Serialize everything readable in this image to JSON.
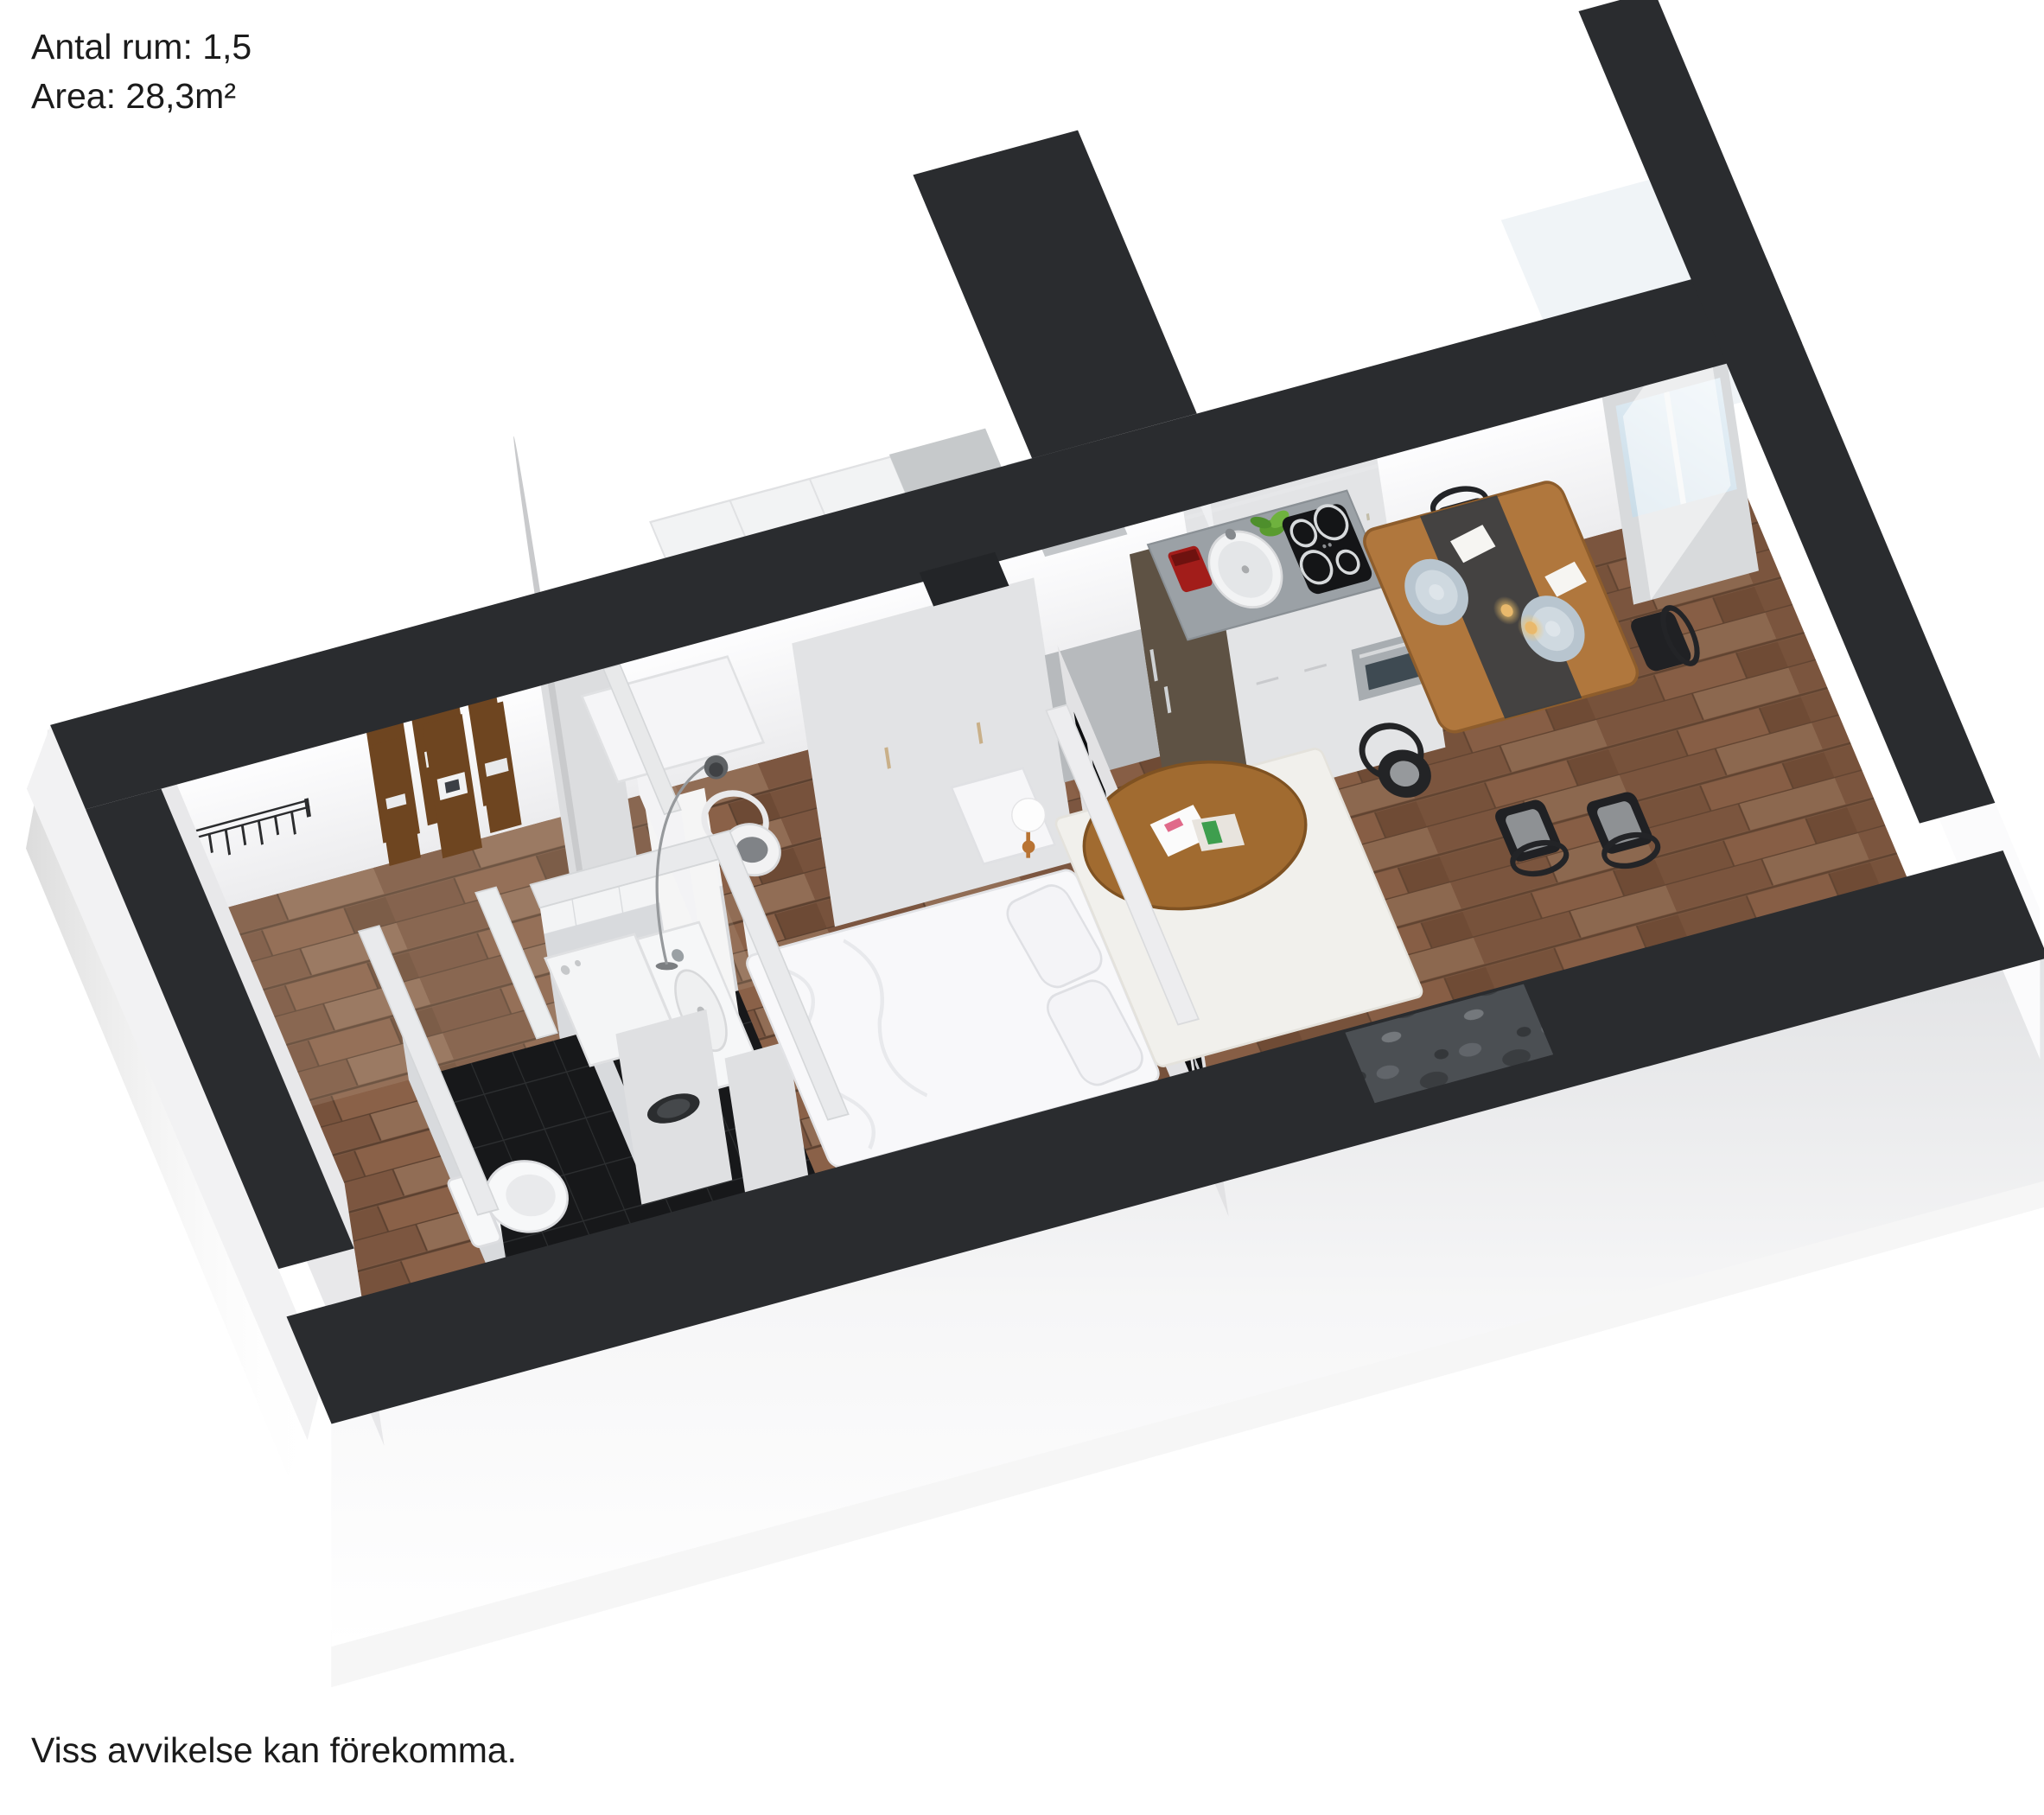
{
  "header": {
    "rooms_label": "Antal rum: 1,5",
    "area_label": "Area: 28,3m²"
  },
  "footer": {
    "disclaimer": "Viss avvikelse kan förekomma."
  },
  "plan": {
    "type": "3d-floorplan-render",
    "view": "isometric-dollhouse",
    "colors": {
      "cut_wall_top": "#2a2c2f",
      "interior_wall": "#f4f4f6",
      "wood_floor": "#87614a",
      "bathroom_floor": "#17181a",
      "bathroom_tile": "#f3f4f5",
      "counter": "#9ba1a6",
      "fridge_bronze": "#8b775c",
      "glass": "#d9e7f0",
      "dining_wood": "#b0773d",
      "accent_red": "#a21d1a",
      "plant_green": "#5a9b2f"
    },
    "rooms": [
      {
        "name": "hall",
        "items": [
          "coat-rack",
          "picture-frames",
          "open-door"
        ]
      },
      {
        "name": "bathroom",
        "items": [
          "toilet",
          "washing-machine",
          "vanity-sink",
          "mirror",
          "tiled-walls",
          "black-tile-floor"
        ]
      },
      {
        "name": "work-nook",
        "items": [
          "wall-desk",
          "wishbone-chair",
          "arc-floor-lamp"
        ]
      },
      {
        "name": "sleeping-alcove",
        "items": [
          "bed",
          "pillows",
          "nightstand",
          "globe-lamp",
          "photo-partition-wall"
        ]
      },
      {
        "name": "wardrobe-row",
        "items": [
          "wardrobe",
          "wardrobe",
          "tall-gray-cabinet",
          "fridge"
        ]
      },
      {
        "name": "kitchen",
        "items": [
          "upper-cabinets",
          "coffee-machine",
          "round-sink",
          "plant",
          "cooktop",
          "oven",
          "base-cabinets"
        ]
      },
      {
        "name": "living-area",
        "items": [
          "rug",
          "oval-coffee-table",
          "magazines",
          "black-wishbone-chair"
        ]
      },
      {
        "name": "dining-area",
        "items": [
          "dining-table",
          "plates",
          "candles",
          "dining-chairs",
          "stone-window-sill"
        ]
      },
      {
        "name": "balcony",
        "items": [
          "glass-door",
          "balcony-walls"
        ]
      }
    ]
  }
}
